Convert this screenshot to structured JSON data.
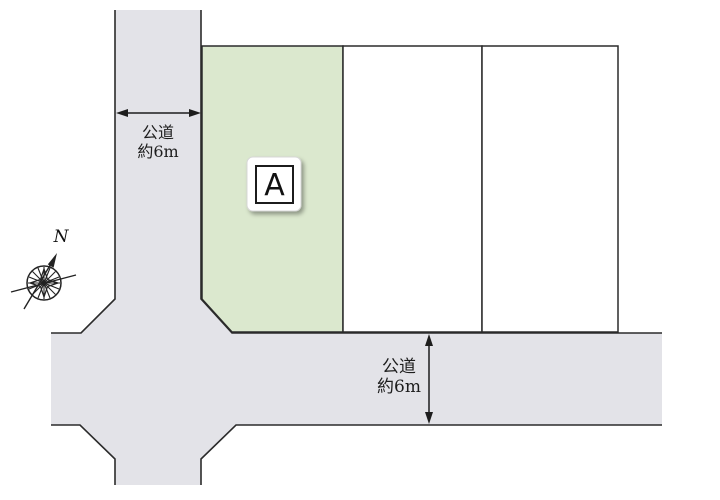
{
  "diagram": {
    "parcels": {
      "a": {
        "label": "A"
      }
    },
    "dimensions": {
      "vertical_road": {
        "line1": "公道",
        "line2": "約6m"
      },
      "horizontal_road": {
        "line1": "公道",
        "line2": "約6m"
      }
    },
    "compass": {
      "north_label": "N"
    },
    "colors": {
      "parcel_a_fill": "#dbe8ce",
      "road_fill": "#e3e3e8",
      "outline": "#2b2b2b"
    }
  }
}
